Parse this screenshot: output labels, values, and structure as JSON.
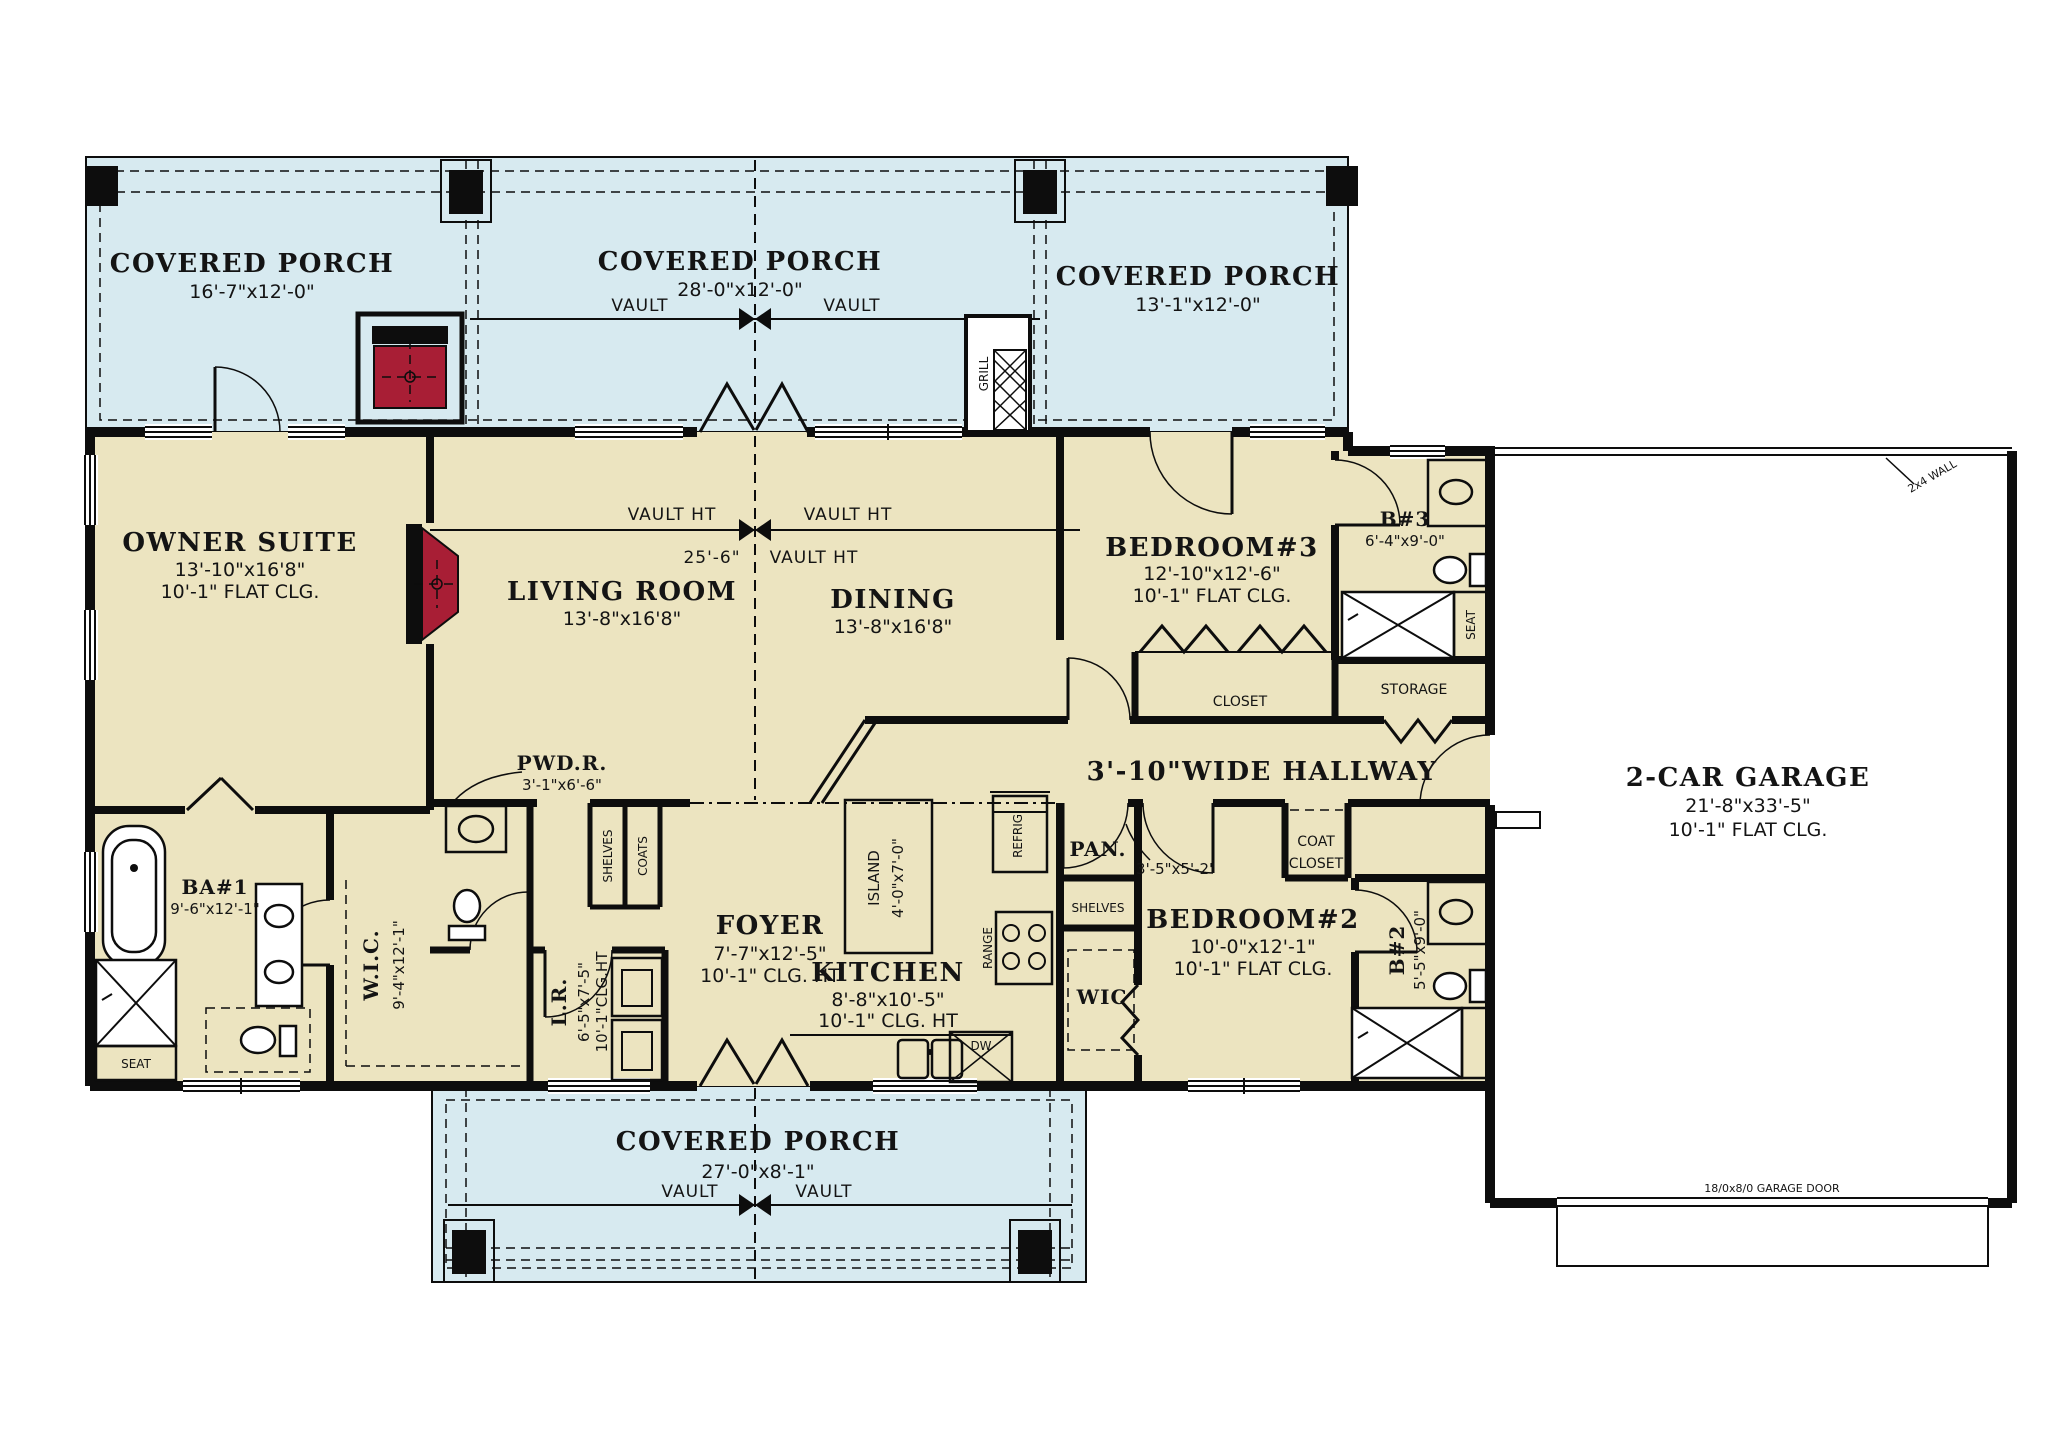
{
  "colors": {
    "porch_fill": "#d7eaf0",
    "room_fill": "#ece4c0",
    "wall": "#0d0d0d",
    "accent_red": "#a81e35",
    "paper": "#ffffff"
  },
  "porches": {
    "left": {
      "title": "COVERED PORCH",
      "dims": "16'-7\"x12'-0\""
    },
    "middle": {
      "title": "COVERED PORCH",
      "dims": "28'-0\"x12'-0\""
    },
    "right": {
      "title": "COVERED PORCH",
      "dims": "13'-1\"x12'-0\""
    },
    "bottom": {
      "title": "COVERED PORCH",
      "dims": "27'-0\"x8'-1\""
    }
  },
  "rooms": {
    "owner_suite": {
      "name": "OWNER SUITE",
      "dims": "13'-10\"x16'8\"",
      "ceiling": "10'-1\" FLAT CLG."
    },
    "living_room": {
      "name": "LIVING ROOM",
      "dims": "13'-8\"x16'8\""
    },
    "dining": {
      "name": "DINING",
      "dims": "13'-8\"x16'8\""
    },
    "bedroom3": {
      "name": "BEDROOM#3",
      "dims": "12'-10\"x12'-6\"",
      "ceiling": "10'-1\" FLAT CLG."
    },
    "bath3": {
      "name": "B#3",
      "dims": "6'-4\"x9'-0\""
    },
    "bedroom2": {
      "name": "BEDROOM#2",
      "dims": "10'-0\"x12'-1\"",
      "ceiling": "10'-1\" FLAT CLG."
    },
    "bath2": {
      "name": "B#2",
      "dims": "5'-5\"x9'-0\""
    },
    "bath1": {
      "name": "BA#1",
      "dims": "9'-6\"x12'-1\""
    },
    "wic_owner": {
      "name": "W.I.C.",
      "dims": "9'-4\"x12'-1\""
    },
    "powder": {
      "name": "PWD.R.",
      "dims": "3'-1\"x6'-6\""
    },
    "laundry": {
      "name": "L.R.",
      "dims": "6'-5\"x7'-5\"",
      "ceiling": "10'-1\"CLG.HT"
    },
    "foyer": {
      "name": "FOYER",
      "dims": "7'-7\"x12'-5\"",
      "ceiling": "10'-1\" CLG. HT"
    },
    "kitchen": {
      "name": "KITCHEN",
      "dims": "8'-8\"x10'-5\"",
      "ceiling": "10'-1\" CLG. HT"
    },
    "island": {
      "name": "ISLAND",
      "dims": "4'-0\"x7'-0\""
    },
    "hallway": {
      "name": "3'-10\"WIDE HALLWAY"
    },
    "garage": {
      "name": "2-CAR GARAGE",
      "dims": "21'-8\"x33'-5\"",
      "ceiling": "10'-1\" FLAT CLG."
    },
    "wic2": {
      "name": "WIC",
      "dims": "3'-5\"x5'-2\""
    },
    "pantry": {
      "name": "PAN."
    },
    "storage": {
      "name": "STORAGE"
    },
    "closet": {
      "name": "CLOSET"
    },
    "coat_closet": {
      "line1": "COAT",
      "line2": "CLOSET"
    }
  },
  "annotations": {
    "vault": "VAULT",
    "vault_ht": "VAULT HT",
    "ridge_height": "25'-6\"",
    "grill": "GRILL",
    "seat": "SEAT",
    "shelves": "SHELVES",
    "coats": "COATS",
    "refrigerator": "REFRIG.",
    "range": "RANGE",
    "dishwasher": "DW",
    "garage_door": "18/0x8/0 GARAGE DOOR",
    "wall_note": "2x4 WALL"
  }
}
